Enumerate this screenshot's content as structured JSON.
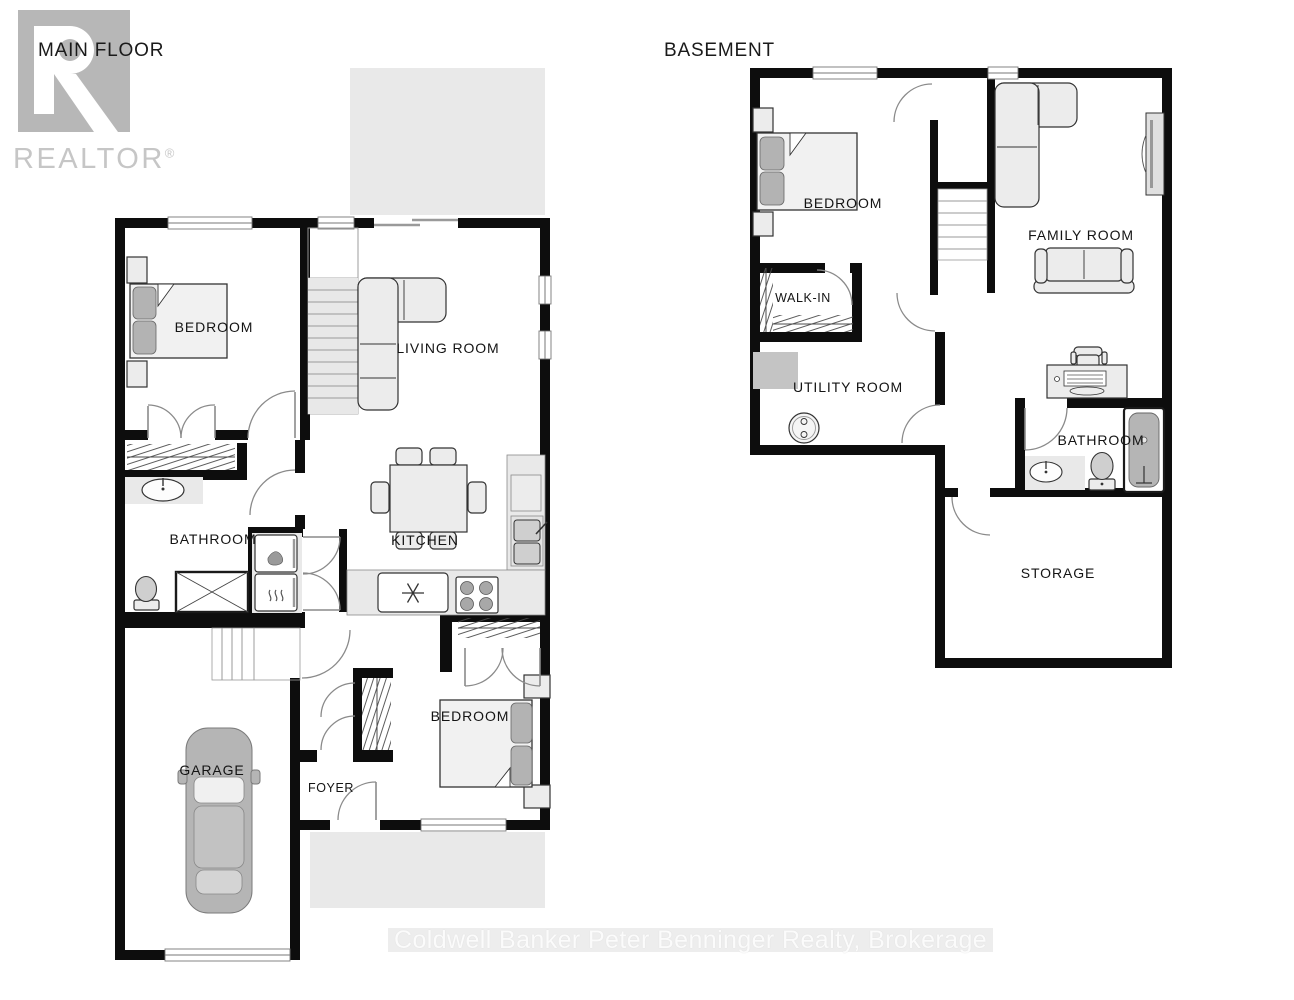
{
  "titles": {
    "main_floor": "MAIN FLOOR",
    "basement": "BASEMENT"
  },
  "logo": {
    "name": "REALTOR",
    "registered_mark": "®"
  },
  "main_floor": {
    "rooms": {
      "bedroom_upper": "BEDROOM",
      "living_room": "LIVING ROOM",
      "bathroom": "BATHROOM",
      "kitchen": "KITCHEN",
      "bedroom_lower": "BEDROOM",
      "foyer": "FOYER",
      "garage": "GARAGE"
    }
  },
  "basement": {
    "rooms": {
      "bedroom": "BEDROOM",
      "walk_in": "WALK-IN",
      "family_room": "FAMILY ROOM",
      "utility_room": "UTILITY ROOM",
      "bathroom": "BATHROOM",
      "storage": "STORAGE"
    }
  },
  "watermark": "Coldwell Banker Peter Benninger Realty, Brokerage",
  "colors": {
    "wall": "#0d0d0d",
    "furniture_fill": "#ececec",
    "accent_gray": "#b3b3b3",
    "area_gray": "#e9e9e9",
    "logo_gray": "#b7b7b7",
    "logo_text_gray": "#c6c6c6",
    "label_text": "#141414",
    "watermark_band": "#ededed",
    "watermark_text": "#fbfbfb"
  }
}
